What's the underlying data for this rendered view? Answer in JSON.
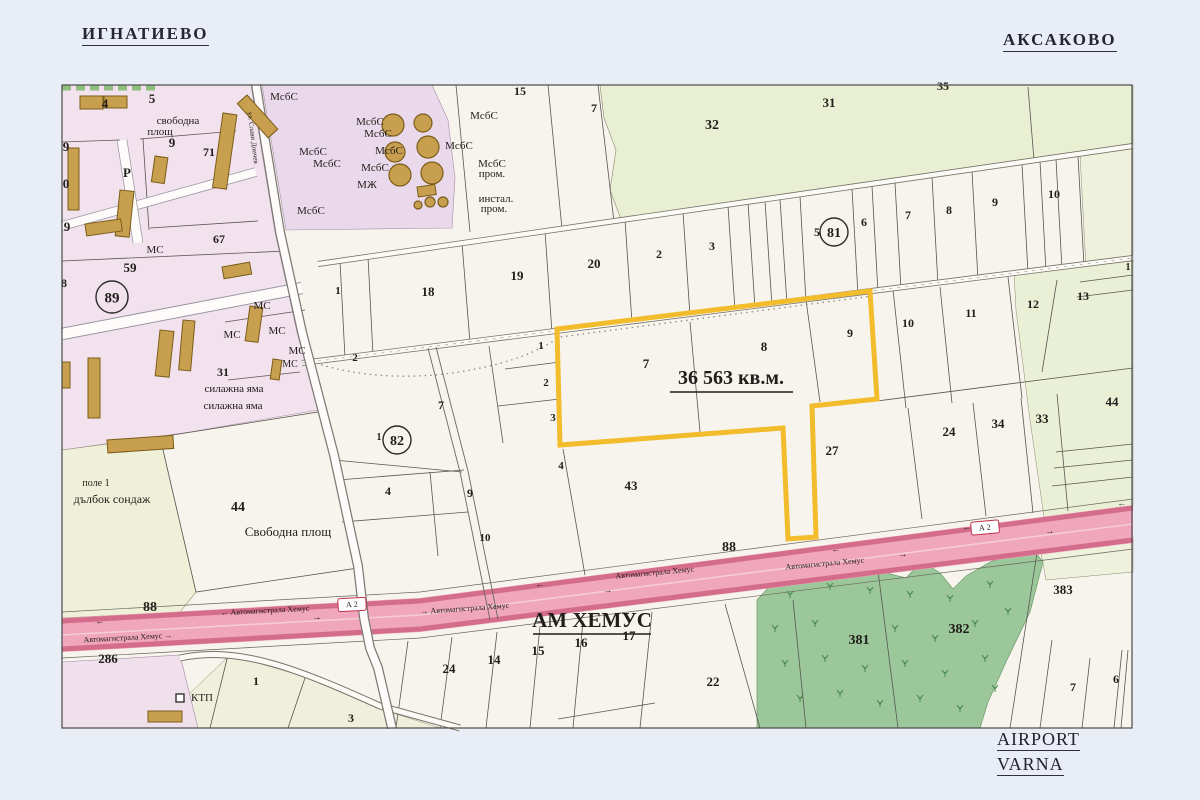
{
  "header": {
    "town_left": "ИГНАТИЕВО",
    "town_right": "АКСАКОВО"
  },
  "footer": {
    "airport_line1": "AIRPORT",
    "airport_line2": "VARNA"
  },
  "parcel": {
    "area_label": "36 563 кв.м."
  },
  "highway": {
    "name_label": "АМ ХЕМУС",
    "road_name": "Автомагистрала Хемус",
    "badge": "А 2",
    "road_number": "88"
  },
  "colors": {
    "accent_parcel": "#f2bc2c",
    "highway_fill": "#f0a6bc",
    "forest": "#9bc79a",
    "urban": "#f2e2ee"
  },
  "map": {
    "labels": [
      {
        "t": "4",
        "x": 105,
        "y": 108,
        "fs": 13,
        "b": 1
      },
      {
        "t": "5",
        "x": 152,
        "y": 103,
        "fs": 13,
        "b": 1
      },
      {
        "t": "свободна",
        "x": 178,
        "y": 124,
        "fs": 11
      },
      {
        "t": "площ",
        "x": 160,
        "y": 135,
        "fs": 11
      },
      {
        "t": "9",
        "x": 66,
        "y": 151,
        "fs": 13,
        "b": 1
      },
      {
        "t": "9",
        "x": 172,
        "y": 147,
        "fs": 13,
        "b": 1
      },
      {
        "t": "71",
        "x": 209,
        "y": 156,
        "fs": 12,
        "b": 1
      },
      {
        "t": "0",
        "x": 66,
        "y": 188,
        "fs": 13,
        "b": 1
      },
      {
        "t": "9",
        "x": 67,
        "y": 231,
        "fs": 13,
        "b": 1
      },
      {
        "t": "Р",
        "x": 127,
        "y": 177,
        "fs": 13,
        "b": 1,
        "col": "#4aa3e8"
      },
      {
        "t": "МС",
        "x": 155,
        "y": 253,
        "fs": 11
      },
      {
        "t": "67",
        "x": 219,
        "y": 243,
        "fs": 12,
        "b": 1
      },
      {
        "t": "59",
        "x": 130,
        "y": 272,
        "fs": 13,
        "b": 1
      },
      {
        "t": "8",
        "x": 64,
        "y": 287,
        "fs": 12,
        "b": 1
      },
      {
        "t": "89",
        "x": 112,
        "y": 297,
        "fs": 15,
        "b": 1,
        "circ": 16
      },
      {
        "t": "МС",
        "x": 262,
        "y": 309,
        "fs": 11
      },
      {
        "t": "МС",
        "x": 232,
        "y": 338,
        "fs": 11
      },
      {
        "t": "МС",
        "x": 277,
        "y": 334,
        "fs": 11
      },
      {
        "t": "МС",
        "x": 297,
        "y": 354,
        "fs": 11
      },
      {
        "t": "МС",
        "x": 290,
        "y": 367,
        "fs": 10
      },
      {
        "t": "31",
        "x": 223,
        "y": 376,
        "fs": 12,
        "b": 1
      },
      {
        "t": "силажна яма",
        "x": 234,
        "y": 392,
        "fs": 11
      },
      {
        "t": "силажна яма",
        "x": 233,
        "y": 409,
        "fs": 11
      },
      {
        "t": "ул. Слави Дончев",
        "x": 251,
        "y": 138,
        "fs": 7,
        "rot": 83,
        "col": "#5a5a6a"
      },
      {
        "t": "МсбС",
        "x": 284,
        "y": 100,
        "fs": 11
      },
      {
        "t": "МсбС",
        "x": 313,
        "y": 155,
        "fs": 11
      },
      {
        "t": "МсбС",
        "x": 327,
        "y": 167,
        "fs": 11
      },
      {
        "t": "МсбС",
        "x": 370,
        "y": 125,
        "fs": 11
      },
      {
        "t": "МсбС",
        "x": 378,
        "y": 137,
        "fs": 11
      },
      {
        "t": "МсбС",
        "x": 389,
        "y": 154,
        "fs": 11
      },
      {
        "t": "МсбС",
        "x": 375,
        "y": 171,
        "fs": 11
      },
      {
        "t": "МЖ",
        "x": 367,
        "y": 188,
        "fs": 11
      },
      {
        "t": "МсбС",
        "x": 311,
        "y": 214,
        "fs": 11
      },
      {
        "t": "МсбС",
        "x": 484,
        "y": 119,
        "fs": 11
      },
      {
        "t": "МсбС",
        "x": 459,
        "y": 149,
        "fs": 11
      },
      {
        "t": "МсбС",
        "x": 492,
        "y": 167,
        "fs": 11
      },
      {
        "t": "пром.",
        "x": 492,
        "y": 177,
        "fs": 11
      },
      {
        "t": "инстал.",
        "x": 496,
        "y": 202,
        "fs": 11
      },
      {
        "t": "пром.",
        "x": 494,
        "y": 212,
        "fs": 11
      },
      {
        "t": "15",
        "x": 520,
        "y": 95,
        "fs": 12,
        "b": 1
      },
      {
        "t": "7",
        "x": 594,
        "y": 112,
        "fs": 12,
        "b": 1
      },
      {
        "t": "32",
        "x": 712,
        "y": 129,
        "fs": 14,
        "b": 1
      },
      {
        "t": "31",
        "x": 829,
        "y": 107,
        "fs": 13,
        "b": 1
      },
      {
        "t": "35",
        "x": 943,
        "y": 90,
        "fs": 12,
        "b": 1
      },
      {
        "t": "1",
        "x": 338,
        "y": 294,
        "fs": 11,
        "b": 1
      },
      {
        "t": "18",
        "x": 428,
        "y": 296,
        "fs": 13,
        "b": 1
      },
      {
        "t": "19",
        "x": 517,
        "y": 280,
        "fs": 13,
        "b": 1
      },
      {
        "t": "20",
        "x": 594,
        "y": 268,
        "fs": 13,
        "b": 1
      },
      {
        "t": "2",
        "x": 659,
        "y": 258,
        "fs": 12,
        "b": 1
      },
      {
        "t": "3",
        "x": 712,
        "y": 250,
        "fs": 12,
        "b": 1
      },
      {
        "t": "2",
        "x": 355,
        "y": 361,
        "fs": 11,
        "b": 1
      },
      {
        "t": "5",
        "x": 817,
        "y": 236,
        "fs": 12,
        "b": 1
      },
      {
        "t": "81",
        "x": 834,
        "y": 232,
        "fs": 14,
        "b": 1,
        "circ": 14
      },
      {
        "t": "6",
        "x": 864,
        "y": 226,
        "fs": 12,
        "b": 1
      },
      {
        "t": "7",
        "x": 908,
        "y": 219,
        "fs": 12,
        "b": 1
      },
      {
        "t": "8",
        "x": 949,
        "y": 214,
        "fs": 12,
        "b": 1
      },
      {
        "t": "9",
        "x": 995,
        "y": 206,
        "fs": 12,
        "b": 1
      },
      {
        "t": "10",
        "x": 1054,
        "y": 198,
        "fs": 12,
        "b": 1
      },
      {
        "t": "1",
        "x": 1128,
        "y": 270,
        "fs": 10,
        "b": 1
      },
      {
        "t": "1",
        "x": 541,
        "y": 349,
        "fs": 11,
        "b": 1
      },
      {
        "t": "2",
        "x": 546,
        "y": 386,
        "fs": 11,
        "b": 1
      },
      {
        "t": "3",
        "x": 553,
        "y": 421,
        "fs": 11,
        "b": 1
      },
      {
        "t": "7",
        "x": 441,
        "y": 409,
        "fs": 12,
        "b": 1
      },
      {
        "t": "1",
        "x": 379,
        "y": 440,
        "fs": 10,
        "b": 1
      },
      {
        "t": "82",
        "x": 397,
        "y": 440,
        "fs": 14,
        "b": 1,
        "circ": 14
      },
      {
        "t": "7",
        "x": 646,
        "y": 368,
        "fs": 13,
        "b": 1
      },
      {
        "t": "8",
        "x": 764,
        "y": 351,
        "fs": 13,
        "b": 1
      },
      {
        "t": "9",
        "x": 850,
        "y": 337,
        "fs": 12,
        "b": 1
      },
      {
        "t": "36 563 кв.м.",
        "x": 731,
        "y": 384,
        "fs": 20,
        "b": 1,
        "n": "parcel-area-label"
      },
      {
        "t": "10",
        "x": 908,
        "y": 327,
        "fs": 12,
        "b": 1
      },
      {
        "t": "11",
        "x": 971,
        "y": 317,
        "fs": 12,
        "b": 1
      },
      {
        "t": "12",
        "x": 1033,
        "y": 308,
        "fs": 12,
        "b": 1
      },
      {
        "t": "13",
        "x": 1083,
        "y": 300,
        "fs": 12,
        "b": 1
      },
      {
        "t": "4",
        "x": 561,
        "y": 469,
        "fs": 11,
        "b": 1
      },
      {
        "t": "4",
        "x": 388,
        "y": 495,
        "fs": 12,
        "b": 1
      },
      {
        "t": "9",
        "x": 470,
        "y": 497,
        "fs": 12,
        "b": 1
      },
      {
        "t": "10",
        "x": 485,
        "y": 541,
        "fs": 11,
        "b": 1
      },
      {
        "t": "43",
        "x": 631,
        "y": 490,
        "fs": 13,
        "b": 1
      },
      {
        "t": "27",
        "x": 832,
        "y": 455,
        "fs": 13,
        "b": 1
      },
      {
        "t": "24",
        "x": 949,
        "y": 436,
        "fs": 13,
        "b": 1
      },
      {
        "t": "34",
        "x": 998,
        "y": 428,
        "fs": 13,
        "b": 1
      },
      {
        "t": "33",
        "x": 1042,
        "y": 423,
        "fs": 13,
        "b": 1
      },
      {
        "t": "44",
        "x": 1112,
        "y": 406,
        "fs": 13,
        "b": 1
      },
      {
        "t": "44",
        "x": 238,
        "y": 511,
        "fs": 14,
        "b": 1
      },
      {
        "t": "Свободна площ",
        "x": 288,
        "y": 536,
        "fs": 13
      },
      {
        "t": "поле 1",
        "x": 96,
        "y": 486,
        "fs": 10
      },
      {
        "t": "дълбок сондаж",
        "x": 112,
        "y": 503,
        "fs": 12
      },
      {
        "t": "88",
        "x": 150,
        "y": 611,
        "fs": 14,
        "b": 1
      },
      {
        "t": "88",
        "x": 729,
        "y": 551,
        "fs": 14,
        "b": 1
      },
      {
        "t": "286",
        "x": 108,
        "y": 663,
        "fs": 13,
        "b": 1
      },
      {
        "t": "АМ ХЕМУС",
        "x": 592,
        "y": 627,
        "fs": 21,
        "b": 1,
        "n": "highway-name-label"
      },
      {
        "t": "Автомагистрала Хемус →",
        "x": 128,
        "y": 640,
        "fs": 8,
        "rot": -3,
        "col": "#7c2438"
      },
      {
        "t": "← Автомагистрала Хемус",
        "x": 265,
        "y": 613,
        "fs": 8,
        "rot": -3,
        "col": "#7c2438"
      },
      {
        "t": "→ Автомагистрала Хемус",
        "x": 465,
        "y": 611,
        "fs": 8,
        "rot": -4,
        "col": "#7c2438"
      },
      {
        "t": "Автомагистрала Хемус",
        "x": 655,
        "y": 575,
        "fs": 8,
        "rot": -5,
        "col": "#7c2438"
      },
      {
        "t": "Автомагистрала Хемус",
        "x": 825,
        "y": 566,
        "fs": 8,
        "rot": -5,
        "col": "#7c2438"
      },
      {
        "t": "←",
        "x": 100,
        "y": 624,
        "fs": 9,
        "rot": -3,
        "col": "#7c2438"
      },
      {
        "t": "→",
        "x": 317,
        "y": 620,
        "fs": 9,
        "rot": -3,
        "col": "#7c2438"
      },
      {
        "t": "←",
        "x": 540,
        "y": 587,
        "fs": 9,
        "rot": -5,
        "col": "#7c2438"
      },
      {
        "t": "→",
        "x": 608,
        "y": 593,
        "fs": 9,
        "rot": -5,
        "col": "#7c2438"
      },
      {
        "t": "←",
        "x": 836,
        "y": 552,
        "fs": 9,
        "rot": -5,
        "col": "#7c2438"
      },
      {
        "t": "→",
        "x": 903,
        "y": 557,
        "fs": 9,
        "rot": -5,
        "col": "#7c2438"
      },
      {
        "t": "←",
        "x": 967,
        "y": 530,
        "fs": 9,
        "rot": -5,
        "col": "#7c2438"
      },
      {
        "t": "→",
        "x": 1050,
        "y": 534,
        "fs": 9,
        "rot": -5,
        "col": "#7c2438"
      },
      {
        "t": "←",
        "x": 1122,
        "y": 506,
        "fs": 9,
        "rot": -5,
        "col": "#7c2438"
      },
      {
        "t": "А 2",
        "x": 352,
        "y": 607,
        "fs": 8,
        "rot": -3,
        "col": "#c03048",
        "n": "highway-badge"
      },
      {
        "t": "А 2",
        "x": 985,
        "y": 530,
        "fs": 8,
        "rot": -5,
        "col": "#c03048",
        "n": "highway-badge"
      },
      {
        "t": "КТП",
        "x": 202,
        "y": 701,
        "fs": 11
      },
      {
        "t": "1",
        "x": 256,
        "y": 685,
        "fs": 12,
        "b": 1
      },
      {
        "t": "3",
        "x": 351,
        "y": 722,
        "fs": 12,
        "b": 1
      },
      {
        "t": "24",
        "x": 449,
        "y": 673,
        "fs": 13,
        "b": 1
      },
      {
        "t": "14",
        "x": 494,
        "y": 664,
        "fs": 13,
        "b": 1
      },
      {
        "t": "15",
        "x": 538,
        "y": 655,
        "fs": 13,
        "b": 1
      },
      {
        "t": "16",
        "x": 581,
        "y": 647,
        "fs": 13,
        "b": 1
      },
      {
        "t": "17",
        "x": 629,
        "y": 640,
        "fs": 13,
        "b": 1
      },
      {
        "t": "22",
        "x": 713,
        "y": 686,
        "fs": 13,
        "b": 1
      },
      {
        "t": "381",
        "x": 859,
        "y": 644,
        "fs": 14,
        "b": 1
      },
      {
        "t": "382",
        "x": 959,
        "y": 633,
        "fs": 14,
        "b": 1
      },
      {
        "t": "383",
        "x": 1063,
        "y": 594,
        "fs": 13,
        "b": 1
      },
      {
        "t": "7",
        "x": 1073,
        "y": 691,
        "fs": 12,
        "b": 1
      },
      {
        "t": "6",
        "x": 1116,
        "y": 683,
        "fs": 12,
        "b": 1
      }
    ]
  }
}
